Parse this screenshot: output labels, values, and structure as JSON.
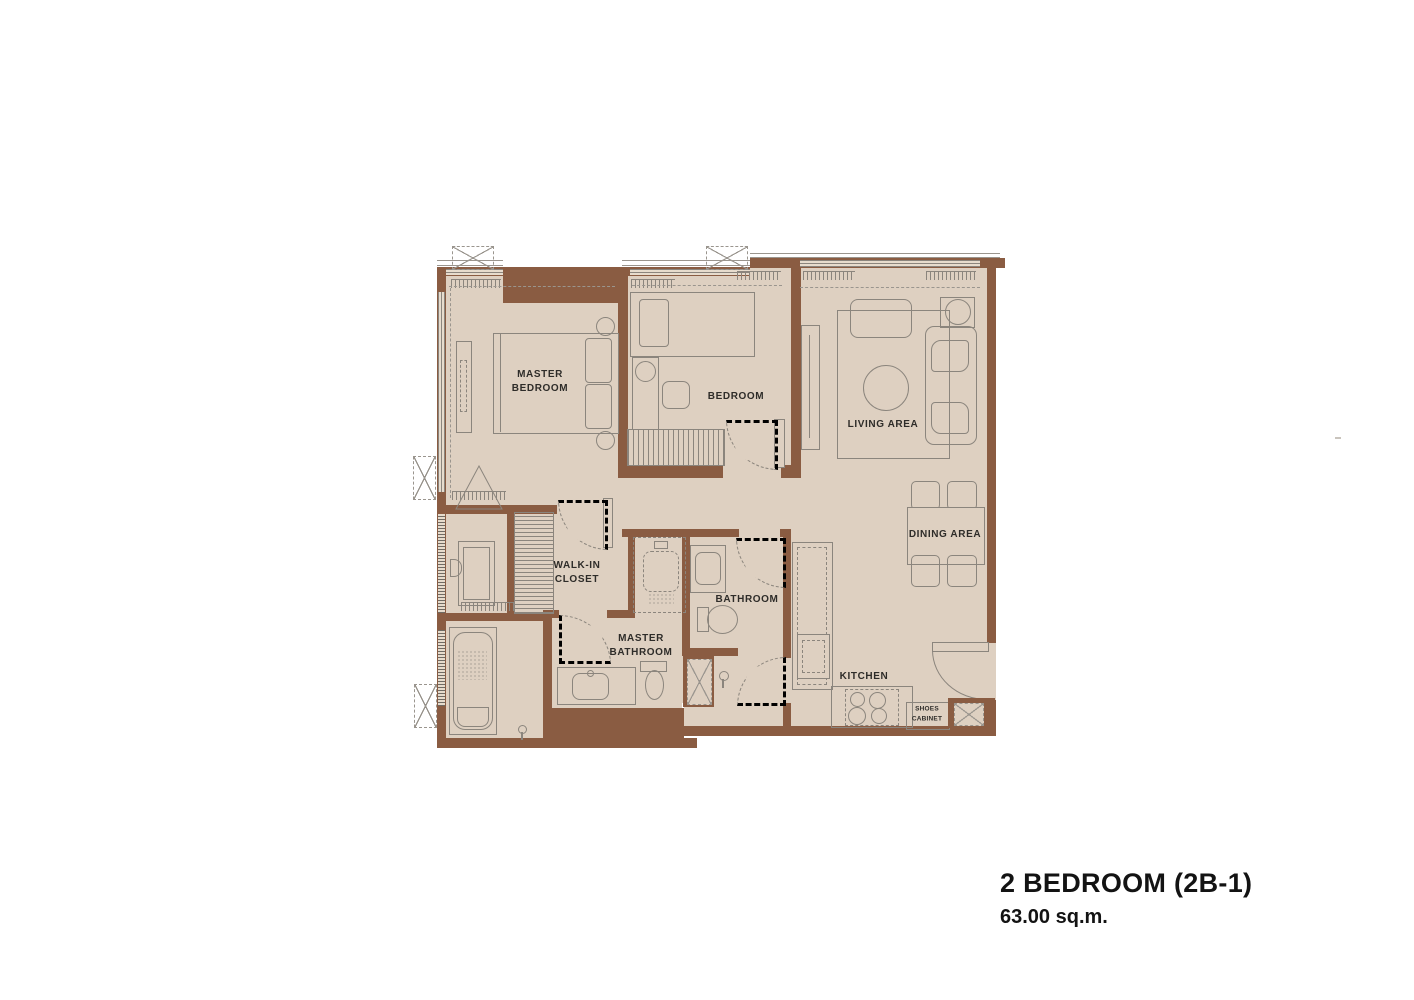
{
  "plan_title": {
    "name": "2 BEDROOM (2B-1)",
    "area": "63.00 sq.m."
  },
  "rooms": {
    "master_bedroom": {
      "label": "MASTER\nBEDROOM"
    },
    "bedroom": {
      "label": "BEDROOM"
    },
    "living_area": {
      "label": "LIVING AREA"
    },
    "dining_area": {
      "label": "DINING AREA"
    },
    "walk_in_closet": {
      "label": "WALK-IN\nCLOSET"
    },
    "bathroom": {
      "label": "BATHROOM"
    },
    "master_bathroom": {
      "label": "MASTER\nBATHROOM"
    },
    "kitchen": {
      "label": "KITCHEN"
    },
    "shoes_cabinet": {
      "label": "SHOES\nCABINET"
    }
  },
  "colors": {
    "wall_brown": "#8a5c42",
    "floor_beige": "#ded0c1",
    "line_gray": "#8b857d",
    "label_text": "#2e2c29"
  }
}
